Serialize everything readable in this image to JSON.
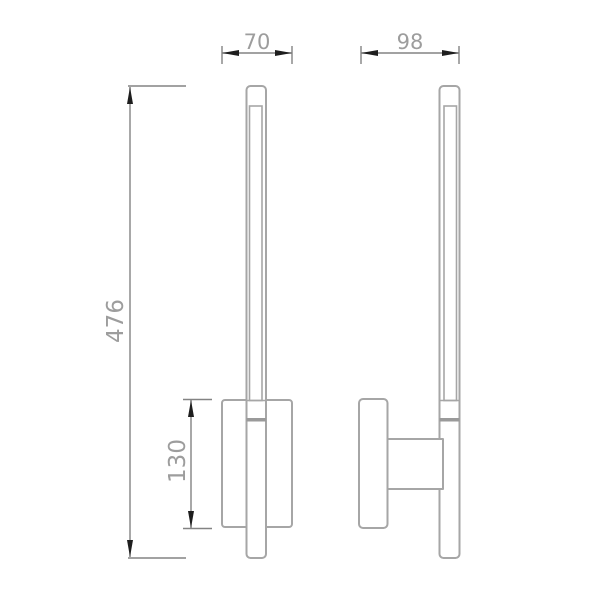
{
  "drawing": {
    "dimensions": {
      "backplate_width": "70",
      "overall_depth": "98",
      "overall_height": "476",
      "backplate_height": "130"
    }
  },
  "colors": {
    "background": "#ffffff",
    "figure_line": "#a6a6a6",
    "dimension_line": "#838383",
    "dimension_text": "#9d9d9d",
    "arrow": "#1e1e1e",
    "joint_band": "#9a9a9a"
  }
}
